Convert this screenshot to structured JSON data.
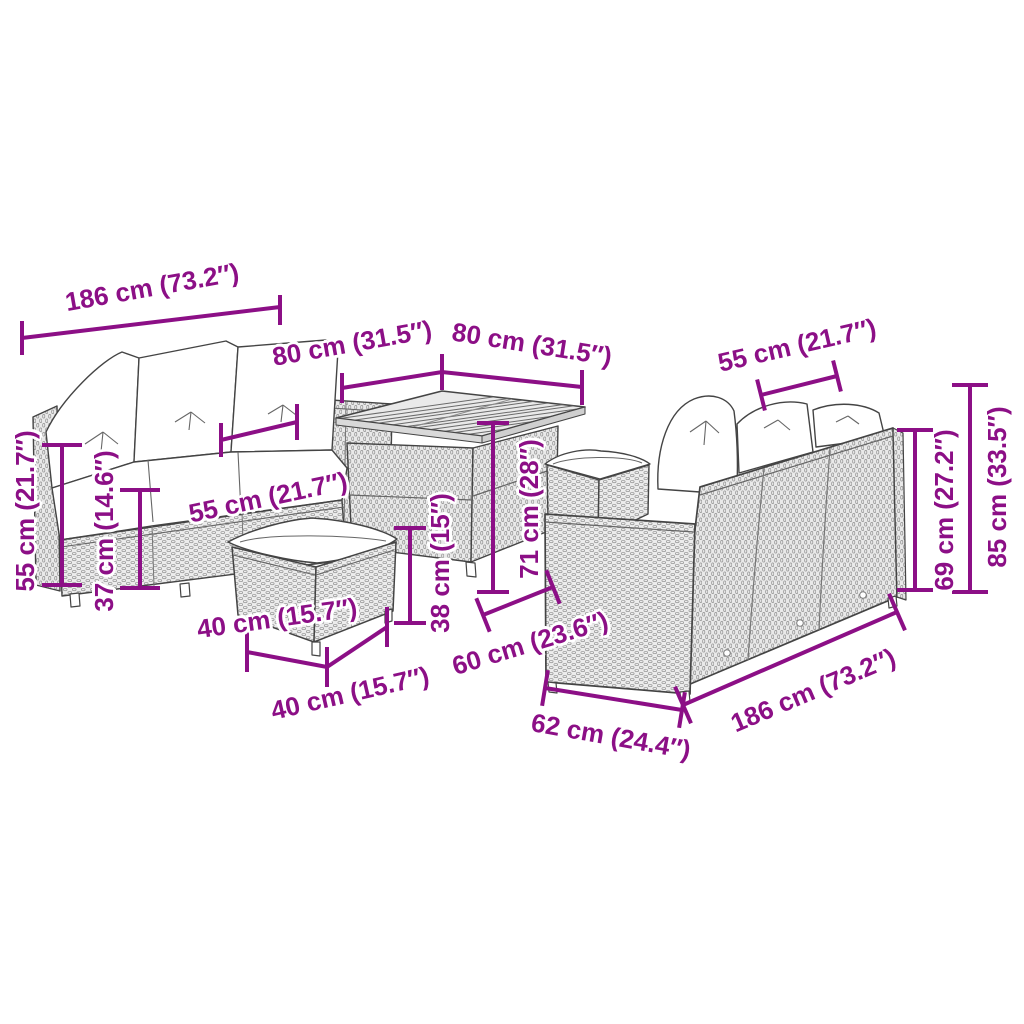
{
  "accent_color": "#8C0F86",
  "background_color": "#ffffff",
  "labels": [
    {
      "id": "sofa-left-width",
      "text": "186 cm (73.2″)"
    },
    {
      "id": "table-width-left",
      "text": "80 cm (31.5″)"
    },
    {
      "id": "table-width-right",
      "text": "80 cm (31.5″)"
    },
    {
      "id": "sofa-right-seat-width",
      "text": "55 cm (21.7″)"
    },
    {
      "id": "sofa-left-height",
      "text": "55 cm (21.7″)"
    },
    {
      "id": "sofa-left-seat-height",
      "text": "37 cm (14.6″)"
    },
    {
      "id": "sofa-left-seat-depth",
      "text": "55 cm (21.7″)"
    },
    {
      "id": "stool-width",
      "text": "40 cm (15.7″)"
    },
    {
      "id": "stool-depth",
      "text": "40 cm (15.7″)"
    },
    {
      "id": "stool-height",
      "text": "38 cm (15″)"
    },
    {
      "id": "table-height",
      "text": "71 cm (28″)"
    },
    {
      "id": "sofa-right-seat-depth",
      "text": "60 cm (23.6″)"
    },
    {
      "id": "sofa-right-base-depth",
      "text": "62 cm (24.4″)"
    },
    {
      "id": "sofa-right-width",
      "text": "186 cm (73.2″)"
    },
    {
      "id": "sofa-right-back-height",
      "text": "69 cm (27.2″)"
    },
    {
      "id": "sofa-right-total-height",
      "text": "85 cm (33.5″)"
    }
  ]
}
